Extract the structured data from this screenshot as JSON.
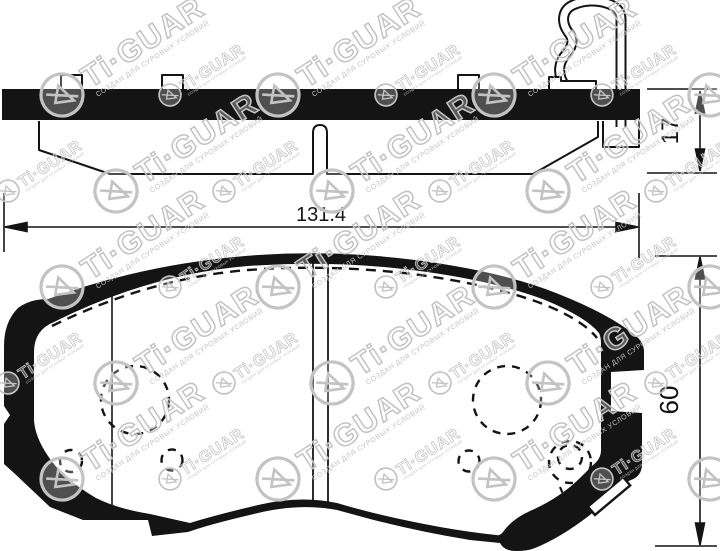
{
  "title": "brake-pad-technical-drawing",
  "colors": {
    "ink": "#141414",
    "background": "#ffffff",
    "watermark": "#c3c3c3"
  },
  "dimensions": {
    "width": "131.4",
    "thickness": "17",
    "height": "60"
  },
  "watermark": {
    "brand": "Ti·GUAR",
    "slogan": "СОЗДАН ДЛЯ СУРОВЫХ УСЛОВИЙ"
  }
}
